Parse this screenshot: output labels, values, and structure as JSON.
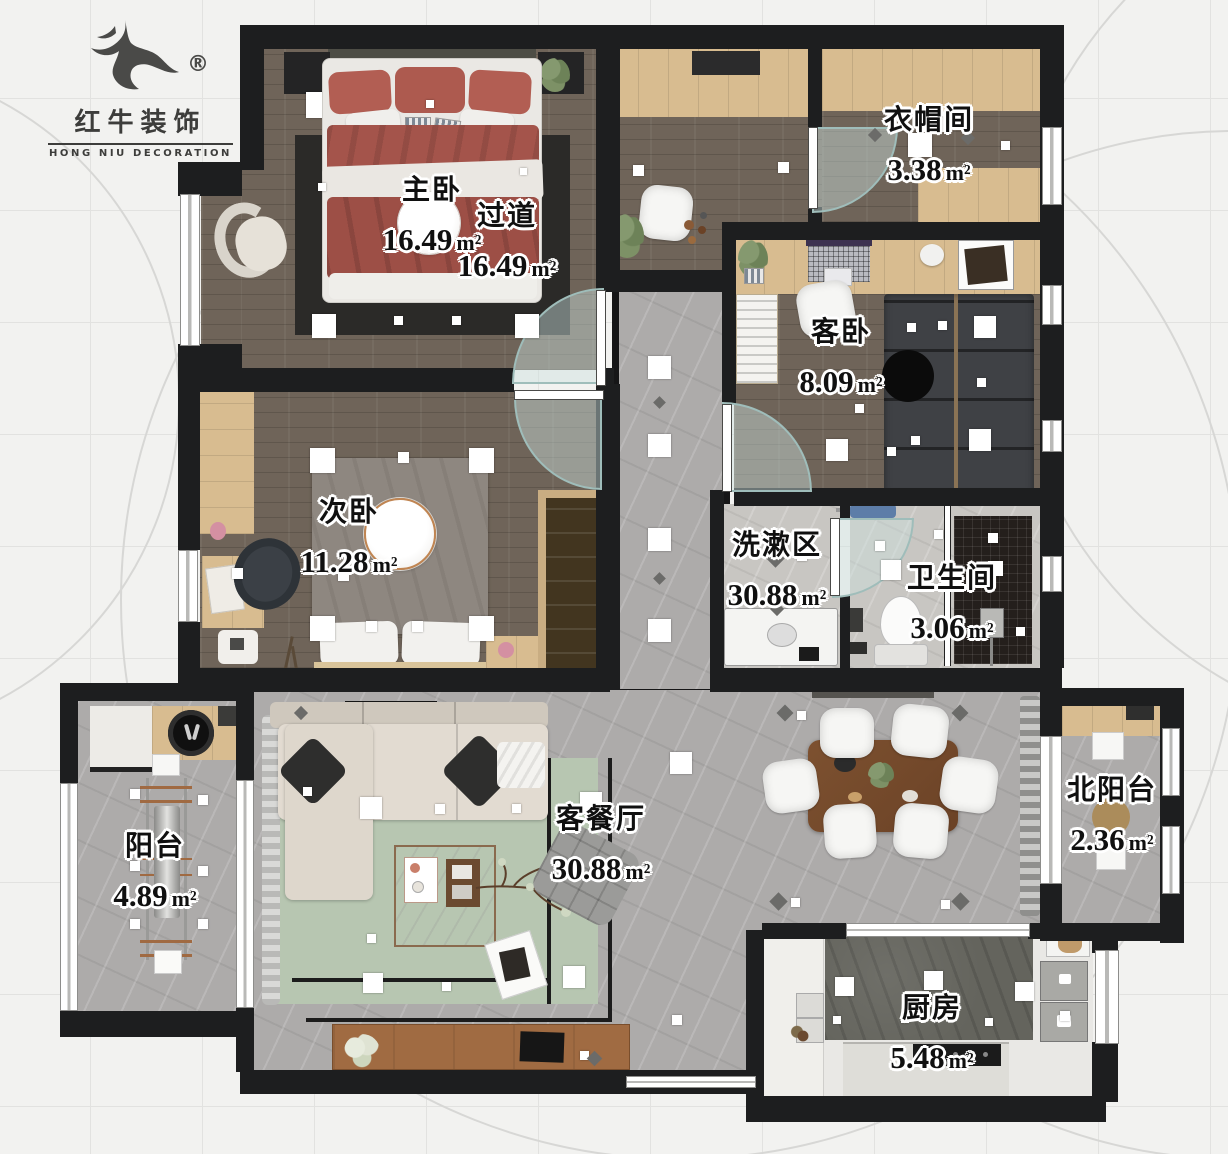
{
  "logo": {
    "brand_cn": "红牛装饰",
    "brand_en": "HONG NIU DECORATION",
    "registered": "®"
  },
  "rooms": [
    {
      "id": "master-bedroom",
      "name": "主卧",
      "area": "16.49",
      "unit": "m²"
    },
    {
      "id": "hallway",
      "name": "过道",
      "area": "16.49",
      "unit": "m²"
    },
    {
      "id": "cloakroom",
      "name": "衣帽间",
      "area": "3.38",
      "unit": "m²"
    },
    {
      "id": "guest-bedroom",
      "name": "客卧",
      "area": "8.09",
      "unit": "m²"
    },
    {
      "id": "second-bedroom",
      "name": "次卧",
      "area": "11.28",
      "unit": "m²"
    },
    {
      "id": "washing-area",
      "name": "洗漱区",
      "area": "30.88",
      "unit": "m²"
    },
    {
      "id": "bathroom",
      "name": "卫生间",
      "area": "3.06",
      "unit": "m²"
    },
    {
      "id": "balcony",
      "name": "阳台",
      "area": "4.89",
      "unit": "m²"
    },
    {
      "id": "living-dining",
      "name": "客餐厅",
      "area": "30.88",
      "unit": "m²"
    },
    {
      "id": "north-balcony",
      "name": "北阳台",
      "area": "2.36",
      "unit": "m²"
    },
    {
      "id": "kitchen",
      "name": "厨房",
      "area": "5.48",
      "unit": "m²"
    }
  ],
  "colors": {
    "wall": "#1d1e1f",
    "wood_dark": "#6f6459",
    "wood_light": "#d8bc90",
    "marble_gray": "#adabaa",
    "rug_green": "#b7c6b1",
    "rug_black": "#2b2a28",
    "bed_red": "#a4544b",
    "glass_door": "#cbe0dd"
  }
}
